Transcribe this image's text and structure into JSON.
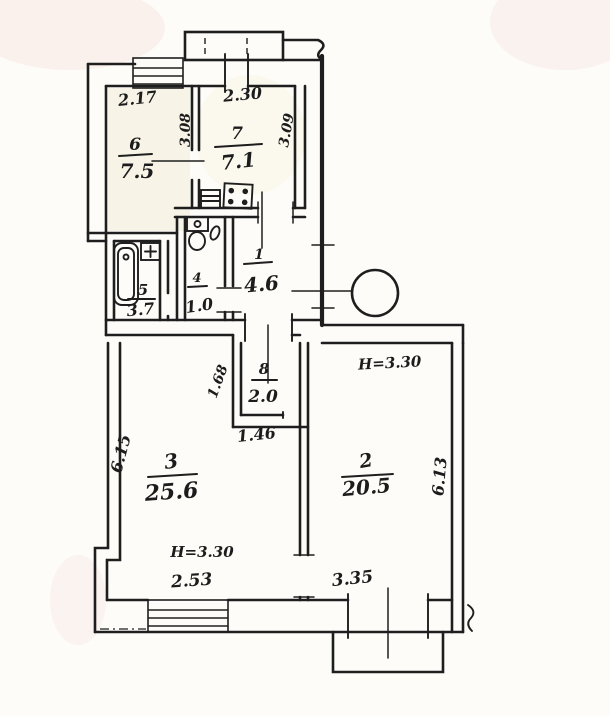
{
  "plan": {
    "colors": {
      "ink": "#1e1e1e",
      "paper": "#fdfcf8"
    },
    "rooms": [
      {
        "number": "6",
        "area": "7.5"
      },
      {
        "number": "7",
        "area": "7.1"
      },
      {
        "number": "5",
        "area": "3.7"
      },
      {
        "number": "4",
        "area": "1.0"
      },
      {
        "number": "1",
        "area": "4.6"
      },
      {
        "number": "8",
        "area": "2.0"
      },
      {
        "number": "3",
        "area": "25.6"
      },
      {
        "number": "2",
        "area": "20.5"
      }
    ],
    "dims": {
      "room6_width": "2.17",
      "room7_width": "2.30",
      "rooms67_depth": "3.08",
      "room7_depth": "3.09",
      "closet_depth": "1.68",
      "closet_width": "1.46",
      "room3_depth": "6.15",
      "room2_depth": "6.13",
      "room3_window": "2.53",
      "room2_window": "3.35",
      "room3_height": "H=3.30",
      "room2_height": "H=3.30"
    }
  }
}
